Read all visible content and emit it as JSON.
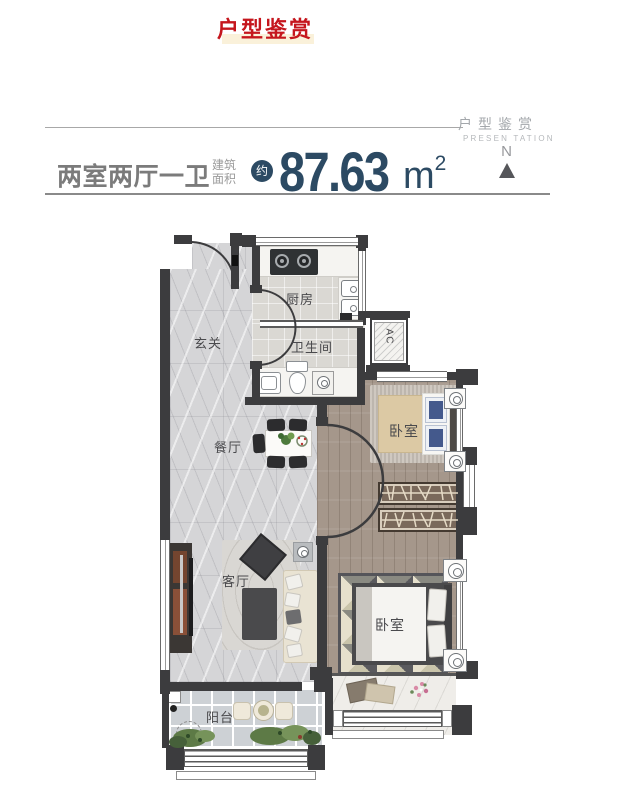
{
  "page": {
    "title": "户型鉴赏"
  },
  "brand": {
    "cn": "户型鉴赏",
    "en": "PRESEN TATION"
  },
  "header": {
    "layout_name": "两室两厅一卫",
    "area_label_top": "建筑",
    "area_label_bottom": "面积",
    "approx": "约",
    "area_value": "87.63",
    "unit_base": "m",
    "unit_exp": "2",
    "compass": "N"
  },
  "rooms": {
    "foyer": "玄关",
    "kitchen": "厨房",
    "bathroom": "卫生间",
    "dining": "餐厅",
    "living": "客厅",
    "bedroom_top": "卧室",
    "bedroom_bottom": "卧室",
    "balcony": "阳台",
    "ac": "AC"
  },
  "colors": {
    "accent_red": "#c5161d",
    "navy": "#2c4a63",
    "heading_gray": "#7b7b7b",
    "wall": "#3c3c3e"
  }
}
